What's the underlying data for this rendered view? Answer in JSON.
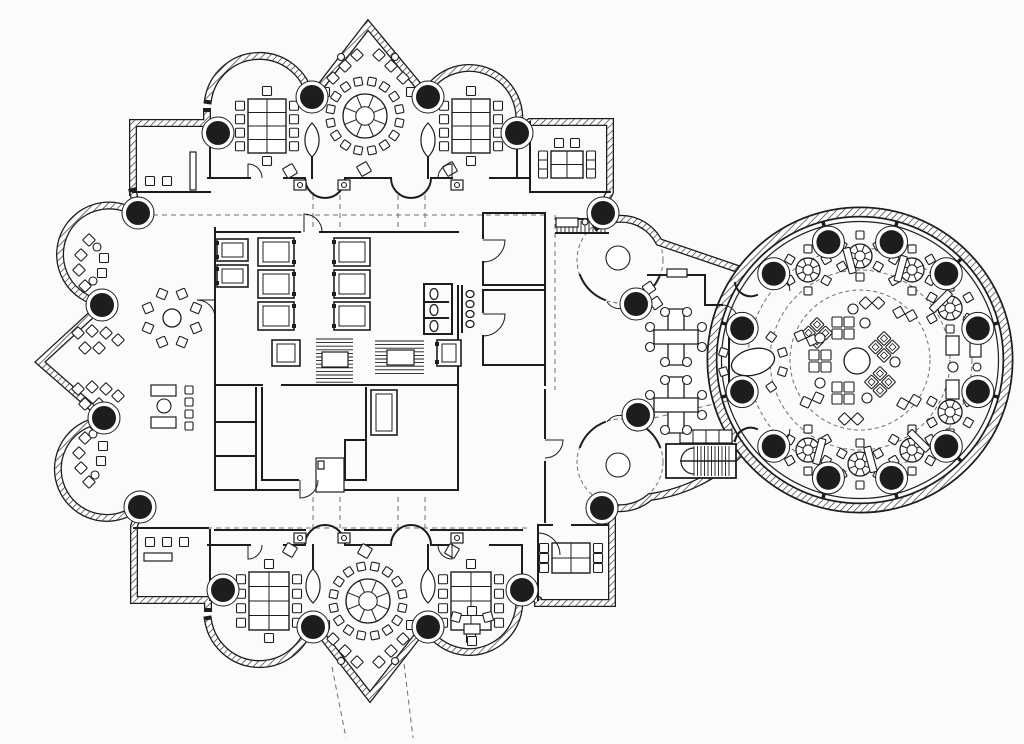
{
  "plan": {
    "canvas": {
      "w": 1024,
      "h": 744
    },
    "colors": {
      "paper": "#fbfbfa",
      "ink": "#1d1d1d",
      "grid": "#6f6f6f",
      "furniture": "#ffffff"
    },
    "hatched": [
      "M133,192 L133,123 L207,123 L207,112",
      "M208,100 A52,52 0 0 1 310,96",
      "M314,95 L368,25 L426,95",
      "M426,93 A50,50 0 0 1 517,133",
      "M517,130 L530,122 L610,122 L610,192 L601,210",
      "M597,226 A43,43 0 0 1 659,242 L741,270",
      "M138,211 L133,192",
      "M138,215 A49,49 0 1 0 102,303",
      "M102,305 L40,362 L104,418",
      "M104,420 A49,49 0 1 0 140,505",
      "M140,509 L134,526 L134,600 L208,600 L208,608",
      "M208,620 A52,52 0 0 0 310,624",
      "M314,625 L370,697 L426,625",
      "M426,627 A50,50 0 0 0 517,587",
      "M524,592 L538,600 L538,603 L612,603 L612,518 L604,511",
      "M741,452 A160,160 0 0 1 650,497 A46,46 0 0 1 603,505"
    ],
    "walls": [
      "M210,123 L210,178",
      "M312,153 L312,178",
      "M428,153 L428,178",
      "M517,135 L517,178",
      "M530,122 L530,192",
      "M530,192 L610,192",
      "M208,178 L250,178 M284,178 L305,178 M345,178 L391,178 M431,178 L452,178 M490,178 L530,178",
      "M305,178 A20,20 0 0 0 325,198 M345,178 A20,20 0 0 1 325,198",
      "M391,178 A20,20 0 0 0 411,198 M431,178 A20,20 0 0 1 411,198",
      "M133,192 L210,192",
      "M134,528 L208,528",
      "M210,530 L210,600",
      "M208,545 L250,545 M284,545 L305,545 M345,545 L391,545 M431,545 L452,545 M490,545 L522,545",
      "M305,545 A20,20 0 0 1 325,525 M345,545 A20,20 0 0 0 325,525",
      "M391,545 A20,20 0 0 1 411,525 M431,545 A20,20 0 0 0 411,525",
      "M313,545 L313,570",
      "M428,545 L428,570",
      "M522,545 L522,588",
      "M215,530 L305,530 M345,530 L391,530 M431,530 L522,530",
      "M538,527 L538,600",
      "M538,525 L552,525 M572,525 L608,525",
      "M215,228 L215,490",
      "M215,232 L300,232 M320,232 L458,232",
      "M215,385 L262,385 M282,385 L458,385",
      "M458,286 L458,385",
      "M215,490 L298,490 M318,490 L458,490",
      "M458,385 L458,490",
      "M262,388 L262,480 M262,480 L298,480 M318,480 L366,480 M366,388 L366,480",
      "M345,440 L366,440 M345,440 L345,480",
      "M256,388 L256,490 M215,422 L256,422 M215,456 L256,456",
      "M424,284 L452,284 M424,284 L424,334 M424,334 L452,334 M452,284 L452,334 M424,302 L448,302 M424,318 L448,318",
      "M462,286 L462,332",
      "M483,213 L545,213 M483,213 L483,238 M483,262 L483,285 M483,285 L545,285",
      "M483,290 L545,290 M483,290 L483,312 M483,336 L483,365 M483,365 L545,365",
      "M545,213 L545,385",
      "M545,390 L545,438 M545,462 L545,522",
      "M648,275 L705,275 L705,305 L722,305",
      "M556,219 L608,219 M556,233 L608,233",
      "M660,275 A43,43 0 0 1 635,300 M605,300 A43,43 0 0 1 580,275",
      "M580,447 A43,43 0 0 1 605,422 M635,422 A43,43 0 0 1 660,447",
      "M735,283 A16,16 0 0 0 757,295 M735,441 A16,16 0 0 1 757,429",
      "M729,338 L729,388"
    ],
    "dashed": [
      "M135,215 L545,215",
      "M135,528 L530,528",
      "M313,195 L313,230 M340,195 L340,230 M398,195 L398,230 M425,195 L425,230",
      "M313,497 L313,528 M340,497 L340,528 M398,497 L398,528 M425,497 L425,528",
      "M555,215 L555,390",
      "M332,667 L346,738",
      "M403,655 L413,738",
      "M645,420 L740,398"
    ],
    "dash_circles": [
      [
        620,
        260,
        43
      ],
      [
        620,
        462,
        43
      ],
      [
        330,
        476,
        9
      ],
      [
        860,
        360,
        70
      ],
      [
        860,
        360,
        90
      ],
      [
        860,
        360,
        112
      ]
    ],
    "doors": [
      "M248,178 L248,164 A14,14 0 0 1 262,178",
      "M452,178 L452,164 A14,14 0 0 0 438,178",
      "M248,545 L248,559 A14,14 0 0 0 262,545",
      "M452,545 L452,559 A14,14 0 0 1 438,545",
      "M483,240 L505,240 A22,22 0 0 1 483,262",
      "M483,314 L505,314 A22,22 0 0 1 483,336",
      "M538,533 A22,22 0 0 1 560,555 M538,533 L538,555",
      "M545,440 L563,440 A18,18 0 0 1 545,458",
      "M215,300 L197,300 A18,18 0 0 1 215,318",
      "M300,480 L300,498 A18,18 0 0 0 318,480",
      "M304,232 L304,214 A18,18 0 0 1 322,232",
      "M768,272 A20,20 0 0 1 790,291",
      "M768,448 A20,20 0 0 0 790,429",
      "M722,305 A16,16 0 0 1 738,321",
      "M633,302 A16,16 0 0 1 607,302",
      "M633,422 A16,16 0 0 0 607,422"
    ],
    "columns": [
      [
        218,
        133
      ],
      [
        312,
        97
      ],
      [
        428,
        97
      ],
      [
        517,
        133
      ],
      [
        603,
        213
      ],
      [
        636,
        304
      ],
      [
        638,
        415
      ],
      [
        602,
        508
      ],
      [
        138,
        213
      ],
      [
        102,
        305
      ],
      [
        104,
        418
      ],
      [
        140,
        507
      ],
      [
        223,
        590
      ],
      [
        313,
        627
      ],
      [
        428,
        627
      ],
      [
        522,
        590
      ]
    ],
    "column_r": 12,
    "lens_piers": [
      [
        312,
        140
      ],
      [
        428,
        140
      ],
      [
        313,
        586
      ],
      [
        428,
        586
      ]
    ],
    "shafts": [
      [
        217,
        239,
        31,
        22,
        "w"
      ],
      [
        217,
        265,
        31,
        22,
        "w"
      ],
      [
        258,
        238,
        36,
        28,
        "e"
      ],
      [
        258,
        270,
        36,
        28,
        "e"
      ],
      [
        258,
        302,
        36,
        28,
        "e"
      ],
      [
        334,
        238,
        36,
        28,
        "w"
      ],
      [
        334,
        270,
        36,
        28,
        "w"
      ],
      [
        334,
        302,
        36,
        28,
        "w"
      ],
      [
        272,
        340,
        28,
        26,
        ""
      ],
      [
        437,
        340,
        24,
        26,
        "w"
      ],
      [
        371,
        390,
        26,
        45,
        ""
      ]
    ],
    "treads": [
      {
        "x": 316,
        "y": 339,
        "w": 37,
        "h": 44,
        "step": 3.6,
        "dir": "h",
        "box": [
          322,
          352,
          26,
          15
        ]
      },
      {
        "x": 375,
        "y": 341,
        "w": 49,
        "h": 36,
        "step": 3.6,
        "dir": "h",
        "box": [
          387,
          350,
          27,
          15
        ]
      },
      {
        "x": 557,
        "y": 221,
        "w": 50,
        "h": 11,
        "step": 4,
        "dir": "v"
      }
    ],
    "grand_stair": {
      "box": [
        666,
        444,
        70,
        34
      ],
      "tx1": 694,
      "tx2": 732,
      "step": 3.5,
      "ty1": 446,
      "ty2": 476,
      "mid_y": 461,
      "cap": "M694,448 A13,13 0 0 0 694,474",
      "lockers": [
        680,
        430,
        52,
        13,
        4
      ]
    },
    "conf_tables": [
      {
        "x": 248,
        "y": 99,
        "w": 38,
        "h": 54,
        "L": 4,
        "R": 4,
        "T": 1,
        "B": 1,
        "grid": "2x4"
      },
      {
        "x": 452,
        "y": 99,
        "w": 38,
        "h": 54,
        "L": 4,
        "R": 4,
        "T": 1,
        "B": 1,
        "grid": "2x4"
      },
      {
        "x": 249,
        "y": 572,
        "w": 40,
        "h": 58,
        "L": 4,
        "R": 4,
        "T": 1,
        "B": 1,
        "grid": "2x4"
      },
      {
        "x": 451,
        "y": 572,
        "w": 40,
        "h": 58,
        "L": 4,
        "R": 4,
        "T": 1,
        "B": 1,
        "grid": "2x4"
      },
      {
        "x": 551,
        "y": 151,
        "w": 32,
        "h": 27,
        "L": 3,
        "R": 3,
        "T": 2,
        "B": 0,
        "grid": "2x2"
      },
      {
        "x": 552,
        "y": 543,
        "w": 38,
        "h": 30,
        "L": 3,
        "R": 3,
        "T": 0,
        "B": 0,
        "grid": "2x2"
      }
    ],
    "ring_tables": [
      {
        "cx": 365,
        "cy": 116,
        "tr": 22,
        "n": 16,
        "cr": 35,
        "ch": 8,
        "spoke": true
      },
      {
        "cx": 368,
        "cy": 601,
        "tr": 22,
        "n": 16,
        "cr": 35,
        "ch": 8,
        "spoke": true
      },
      {
        "cx": 172,
        "cy": 318,
        "tr": 9,
        "n": 8,
        "cr": 26,
        "ch": 9,
        "spoke": false,
        "diamond": true
      },
      {
        "cx": 753,
        "cy": 362,
        "tr": 0,
        "n": 10,
        "cr": 31,
        "ch": 8,
        "spoke": false
      }
    ],
    "crosses": [
      [
        676,
        337
      ],
      [
        676,
        405
      ]
    ],
    "rotunda": {
      "cx": 860,
      "cy": 360,
      "wall_r": 148,
      "inner_r": 138.5,
      "col_r": 122,
      "col_angles": [
        15,
        45,
        75,
        105,
        135,
        165,
        195,
        225,
        255,
        285,
        315,
        345
      ],
      "part_angles": [
        15,
        45,
        75,
        105,
        165,
        195,
        255,
        285,
        315,
        345
      ],
      "part_r1": 121,
      "part_r2": 144,
      "tables": {
        "angles": [
          -120,
          -90,
          -60,
          -30,
          30,
          60,
          90,
          120
        ],
        "rpos": 104,
        "tr": 12,
        "n": 6,
        "cr": 21,
        "ch": 8
      },
      "benches": {
        "angles": [
          45,
          75,
          105,
          255,
          285,
          315
        ],
        "rpos": 100,
        "w": 7,
        "h": 26
      },
      "center": {
        "circle": [
          857,
          361,
          13
        ],
        "clusters": [
          [
            843,
            328,
            0
          ],
          [
            817,
            333,
            45
          ],
          [
            820,
            361,
            0
          ],
          [
            843,
            393,
            0
          ],
          [
            884,
            347,
            45
          ],
          [
            880,
            382,
            45
          ]
        ],
        "pairs": [
          [
            806,
            338,
            20
          ],
          [
            812,
            400,
            -20
          ],
          [
            905,
            314,
            15
          ],
          [
            909,
            402,
            -15
          ],
          [
            851,
            419,
            0
          ],
          [
            872,
            303,
            0
          ]
        ],
        "dots": [
          [
            865,
            323
          ],
          [
            820,
            338
          ],
          [
            820,
            383
          ],
          [
            895,
            362
          ],
          [
            867,
            398
          ],
          [
            853,
            309
          ]
        ]
      }
    },
    "prims": [
      [
        "d",
        333,
        78,
        9,
        45
      ],
      [
        "d",
        345,
        66,
        9,
        45
      ],
      [
        "d",
        357,
        55,
        9,
        45
      ],
      [
        "d",
        379,
        55,
        9,
        45
      ],
      [
        "d",
        391,
        66,
        9,
        45
      ],
      [
        "d",
        403,
        78,
        9,
        45
      ],
      [
        "c",
        341,
        57,
        3.5
      ],
      [
        "c",
        395,
        57,
        3.5
      ],
      [
        "d",
        325,
        92,
        9,
        0
      ],
      [
        "d",
        411,
        92,
        9,
        0
      ],
      [
        "d",
        333,
        639,
        9,
        45
      ],
      [
        "d",
        345,
        651,
        9,
        45
      ],
      [
        "d",
        357,
        662,
        9,
        45
      ],
      [
        "d",
        379,
        662,
        9,
        45
      ],
      [
        "d",
        391,
        651,
        9,
        45
      ],
      [
        "d",
        403,
        639,
        9,
        45
      ],
      [
        "c",
        341,
        661,
        3.5
      ],
      [
        "c",
        395,
        661,
        3.5
      ],
      [
        "d",
        325,
        625,
        9,
        0
      ],
      [
        "d",
        411,
        625,
        9,
        0
      ],
      [
        "q",
        150,
        181,
        0
      ],
      [
        "q",
        167,
        181,
        0
      ],
      [
        "r",
        190,
        152,
        6,
        38,
        0
      ],
      [
        "q",
        150,
        542,
        0
      ],
      [
        "q",
        167,
        542,
        0
      ],
      [
        "q",
        184,
        542,
        0
      ],
      [
        "r",
        144,
        553,
        28,
        8,
        0
      ],
      [
        "r",
        556,
        218,
        22,
        9,
        0
      ],
      [
        "c",
        585,
        222,
        3
      ],
      [
        "d",
        456,
        617,
        9,
        15
      ],
      [
        "d",
        472,
        611,
        9,
        0
      ],
      [
        "d",
        488,
        617,
        9,
        -15
      ],
      [
        "r",
        464,
        624,
        16,
        10,
        0
      ],
      [
        "d",
        472,
        641,
        9,
        0
      ],
      [
        "d",
        89,
        240,
        9,
        45
      ],
      [
        "d",
        81,
        255,
        9,
        45
      ],
      [
        "d",
        79,
        270,
        9,
        45
      ],
      [
        "d",
        85,
        286,
        9,
        45
      ],
      [
        "d",
        96,
        297,
        9,
        45
      ],
      [
        "d",
        104,
        258,
        9,
        0
      ],
      [
        "d",
        102,
        273,
        9,
        0
      ],
      [
        "c",
        97,
        247,
        4
      ],
      [
        "c",
        93,
        281,
        4
      ],
      [
        "d",
        78,
        333,
        9,
        45
      ],
      [
        "d",
        92,
        331,
        9,
        45
      ],
      [
        "d",
        106,
        333,
        9,
        45
      ],
      [
        "d",
        118,
        340,
        9,
        45
      ],
      [
        "d",
        85,
        348,
        9,
        45
      ],
      [
        "d",
        99,
        348,
        9,
        45
      ],
      [
        "d",
        78,
        389,
        9,
        45
      ],
      [
        "d",
        92,
        387,
        9,
        45
      ],
      [
        "d",
        106,
        389,
        9,
        45
      ],
      [
        "d",
        118,
        396,
        9,
        45
      ],
      [
        "d",
        85,
        404,
        9,
        45
      ],
      [
        "d",
        99,
        404,
        9,
        45
      ],
      [
        "d",
        96,
        427,
        9,
        45
      ],
      [
        "d",
        85,
        438,
        9,
        45
      ],
      [
        "d",
        79,
        453,
        9,
        45
      ],
      [
        "d",
        81,
        468,
        9,
        45
      ],
      [
        "d",
        89,
        482,
        9,
        45
      ],
      [
        "d",
        103,
        446,
        9,
        0
      ],
      [
        "d",
        101,
        461,
        9,
        0
      ],
      [
        "c",
        93,
        434,
        4
      ],
      [
        "c",
        95,
        475,
        4
      ],
      [
        "r",
        151,
        385,
        25,
        11,
        0
      ],
      [
        "r",
        151,
        417,
        25,
        11,
        0
      ],
      [
        "c",
        164,
        406,
        7
      ],
      [
        "d",
        189,
        390,
        8,
        0
      ],
      [
        "d",
        189,
        402,
        8,
        0
      ],
      [
        "d",
        189,
        414,
        8,
        0
      ],
      [
        "d",
        189,
        426,
        8,
        0
      ],
      [
        "r",
        667,
        269,
        20,
        8,
        0
      ],
      [
        "d",
        649,
        288,
        10,
        -35
      ],
      [
        "d",
        656,
        303,
        10,
        -35
      ],
      [
        "e",
        753,
        362,
        22,
        13,
        -15
      ],
      [
        "r",
        946,
        336,
        13,
        19,
        0
      ],
      [
        "r",
        946,
        380,
        13,
        19,
        0
      ],
      [
        "r",
        970,
        340,
        11,
        17,
        0
      ],
      [
        "r",
        970,
        379,
        11,
        17,
        0
      ],
      [
        "c",
        953,
        367,
        5
      ],
      [
        "c",
        977,
        367,
        4
      ],
      [
        "e",
        434,
        294,
        4,
        5.5,
        0
      ],
      [
        "e",
        434,
        310,
        4,
        5.5,
        0
      ],
      [
        "e",
        434,
        326,
        4,
        5.5,
        0
      ],
      [
        "e",
        470,
        294,
        4,
        3.5,
        0
      ],
      [
        "e",
        470,
        304,
        4,
        3.5,
        0
      ],
      [
        "e",
        470,
        314,
        4,
        3.5,
        0
      ],
      [
        "e",
        470,
        324,
        4,
        3.5,
        0
      ],
      [
        "r",
        316,
        458,
        28,
        34,
        0
      ],
      [
        "r",
        318,
        461,
        6,
        8,
        0
      ],
      [
        "c",
        618,
        258,
        12
      ],
      [
        "c",
        618,
        465,
        12
      ],
      [
        "r",
        294,
        180,
        12,
        10,
        0
      ],
      [
        "c",
        300,
        185,
        2.5
      ],
      [
        "r",
        338,
        180,
        12,
        10,
        0
      ],
      [
        "c",
        344,
        185,
        2.5
      ],
      [
        "r",
        451,
        180,
        12,
        10,
        0
      ],
      [
        "c",
        457,
        185,
        2.5
      ],
      [
        "r",
        294,
        533,
        12,
        10,
        0
      ],
      [
        "c",
        300,
        538,
        2.5
      ],
      [
        "r",
        338,
        533,
        12,
        10,
        0
      ],
      [
        "c",
        344,
        538,
        2.5
      ],
      [
        "r",
        451,
        533,
        12,
        10,
        0
      ],
      [
        "c",
        457,
        538,
        2.5
      ],
      [
        "d",
        290,
        171,
        11,
        -30
      ],
      [
        "d",
        364,
        169,
        11,
        -30
      ],
      [
        "d",
        450,
        169,
        11,
        -30
      ],
      [
        "d",
        290,
        550,
        11,
        30
      ],
      [
        "d",
        365,
        551,
        11,
        30
      ],
      [
        "d",
        452,
        551,
        11,
        30
      ]
    ]
  }
}
